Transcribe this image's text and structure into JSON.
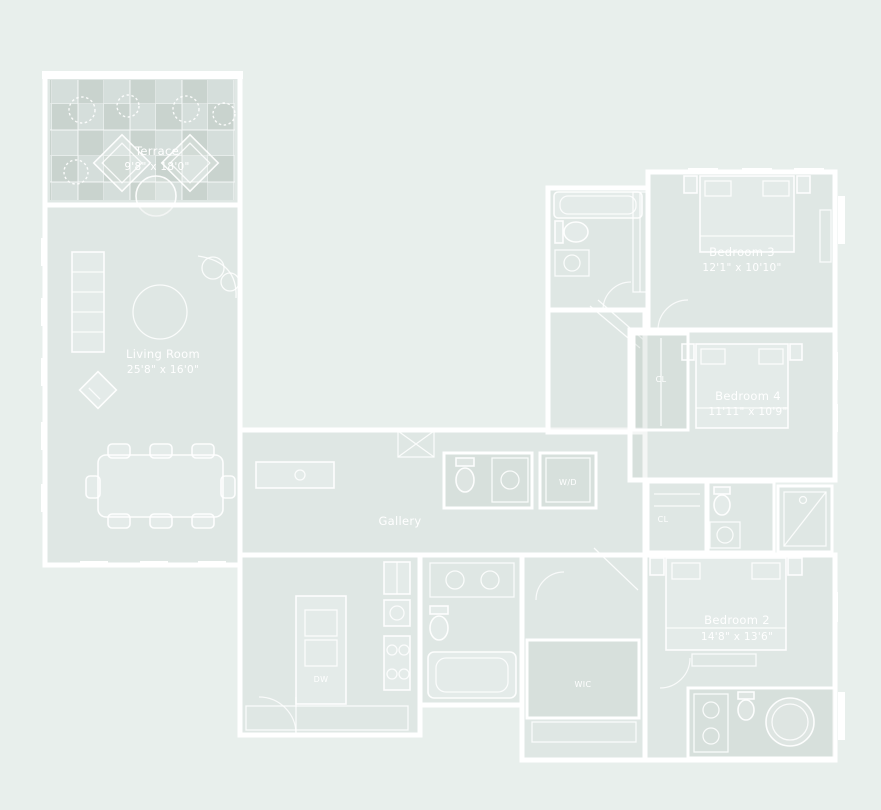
{
  "floor_plan": {
    "colors": {
      "background": "#e8efec",
      "walls": "#ffffff",
      "room_fill": "rgba(150,164,159,0.10)",
      "text": "#ffffff"
    },
    "rooms": [
      {
        "id": "terrace",
        "name": "Terrace",
        "dims": "9'8\" x 18'0\""
      },
      {
        "id": "living-room",
        "name": "Living Room",
        "dims": "25'8\" x 16'0\""
      },
      {
        "id": "gallery",
        "name": "Gallery",
        "dims": ""
      },
      {
        "id": "bedroom-3",
        "name": "Bedroom 3",
        "dims": "12'1\" x 10'10\""
      },
      {
        "id": "bedroom-4",
        "name": "Bedroom 4",
        "dims": "11'11\" x 10'9\""
      },
      {
        "id": "bedroom-2",
        "name": "Bedroom 2",
        "dims": "14'8\" x 13'6\""
      }
    ],
    "annotations": {
      "wic": "WIC",
      "wd": "W/D",
      "dw": "DW",
      "cl": "CL"
    }
  }
}
